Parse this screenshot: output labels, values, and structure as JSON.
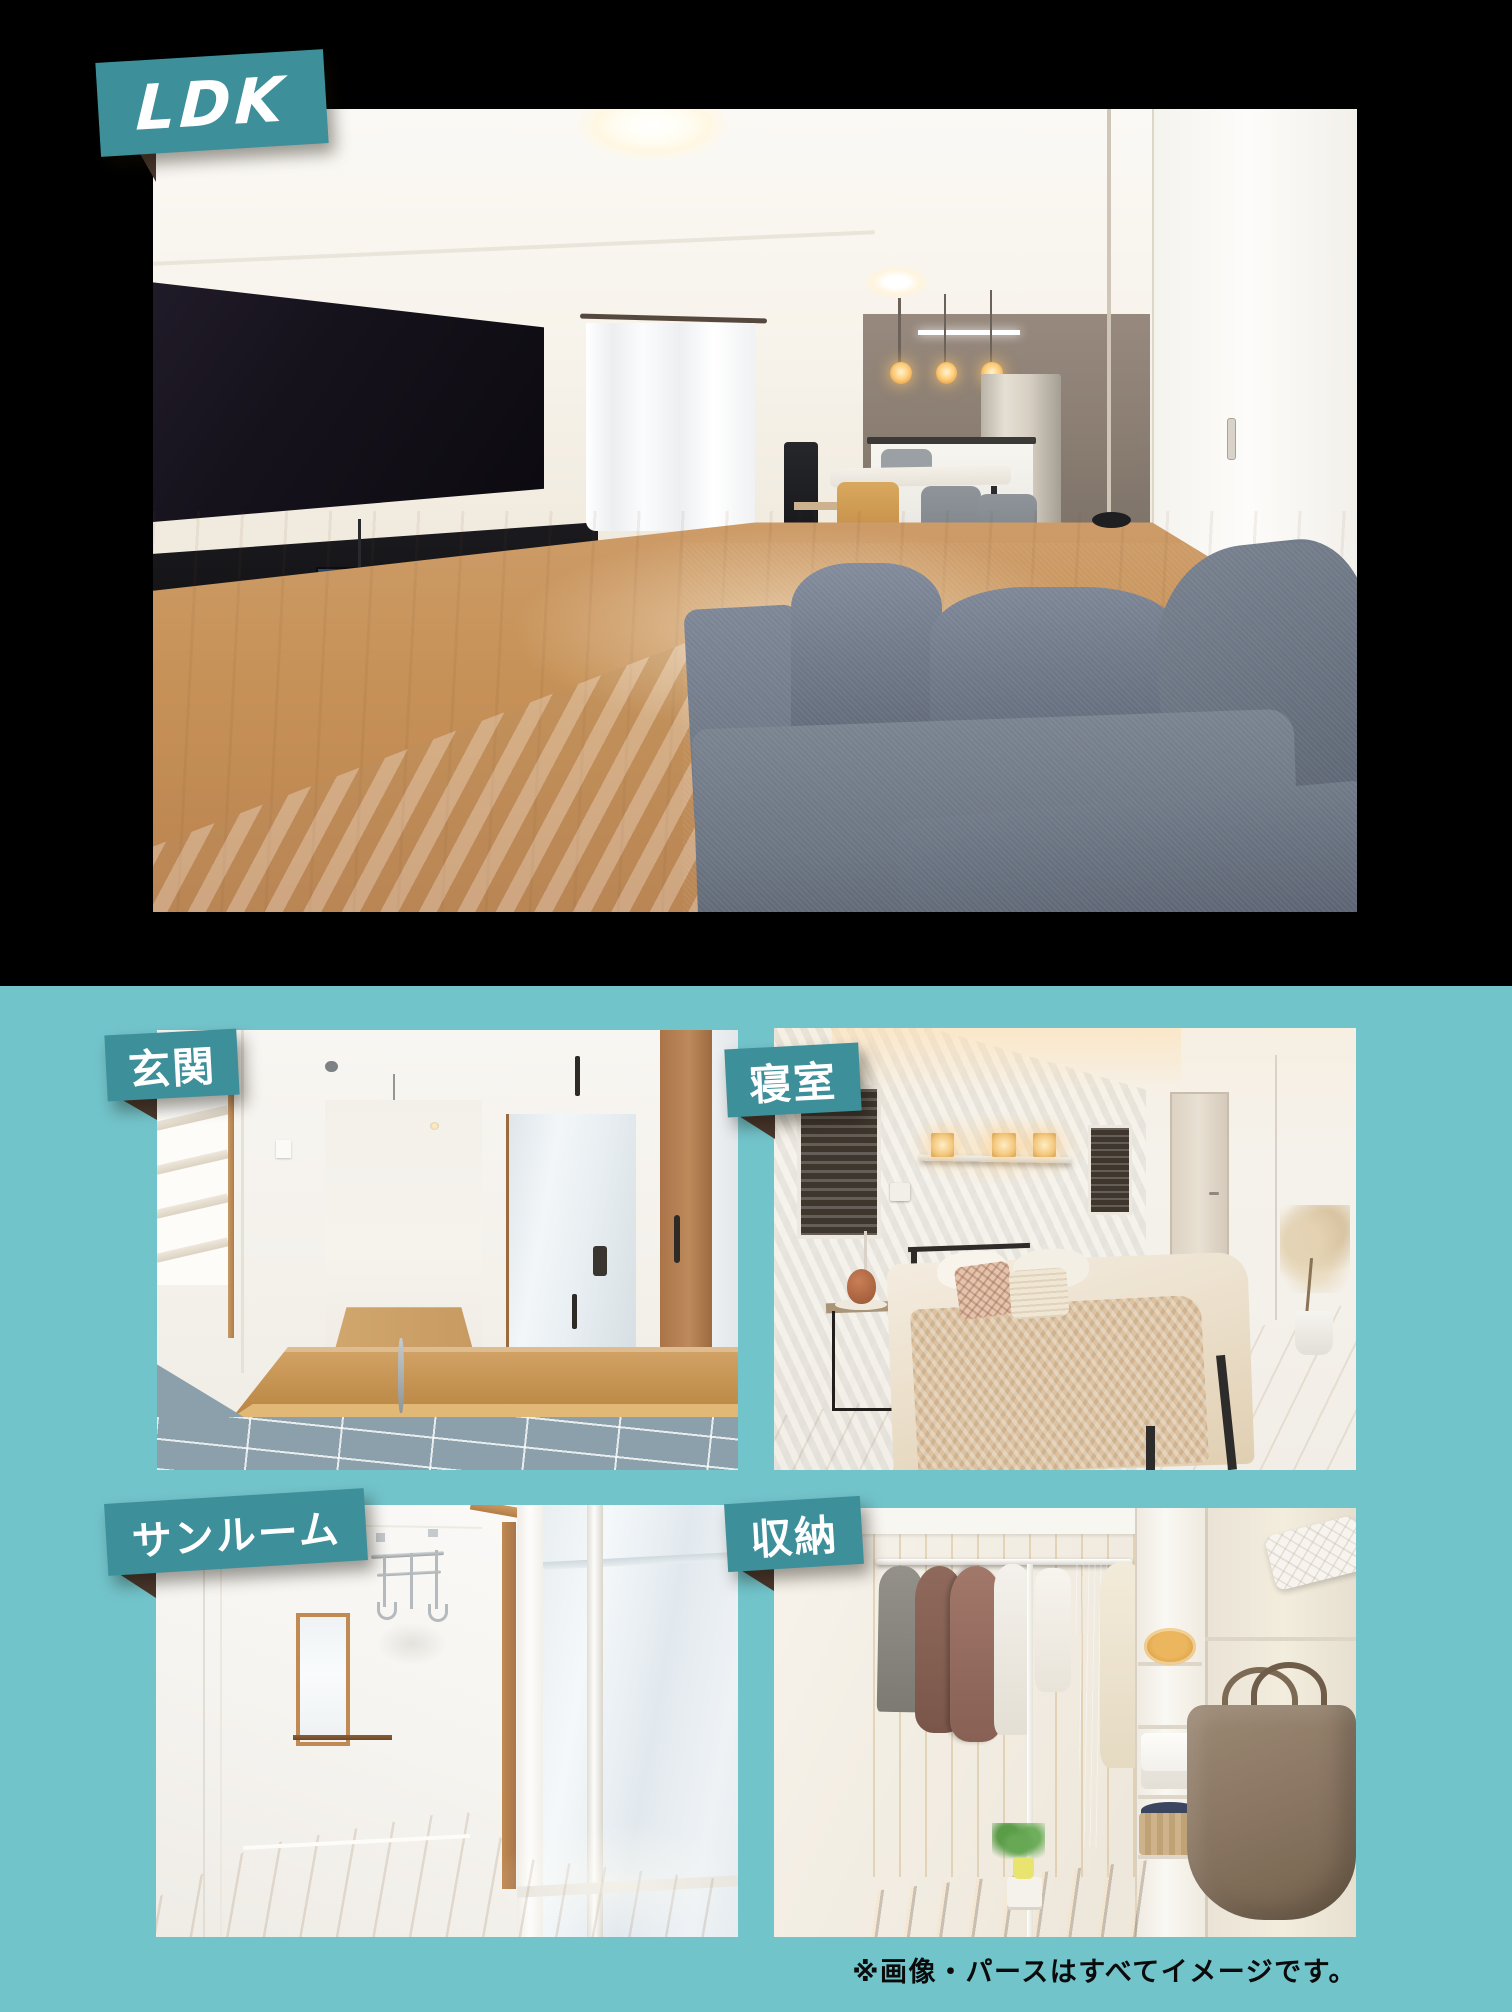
{
  "page": {
    "colors": {
      "black_bg": "#000000",
      "teal_bg": "#72c4cb",
      "badge_teal": "#3d8f9a",
      "badge_text": "#ffffff",
      "fold_brown": "#4a372c",
      "disclaimer_text": "#0b0b0b"
    }
  },
  "hero": {
    "badge_label": "LDK"
  },
  "rooms": [
    {
      "id": "genkan",
      "label": "玄関"
    },
    {
      "id": "shinshitsu",
      "label": "寝室"
    },
    {
      "id": "sunroom",
      "label": "サンルーム"
    },
    {
      "id": "shuunou",
      "label": "収納"
    }
  ],
  "footer": {
    "disclaimer": "※画像・パースはすべてイメージです。"
  }
}
